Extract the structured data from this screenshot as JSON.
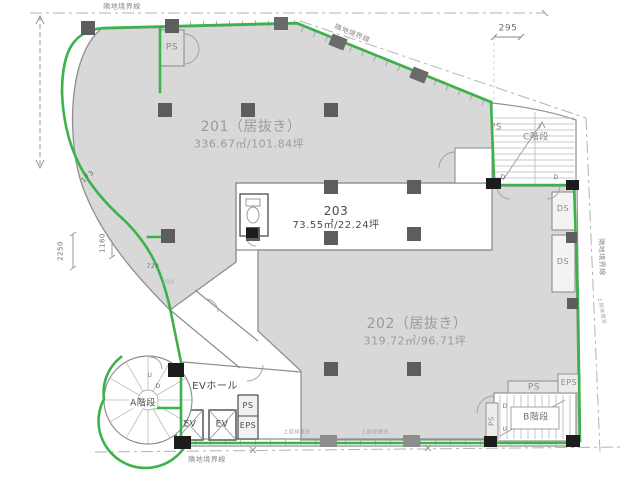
{
  "rooms": {
    "r201": {
      "name": "201（居抜き）",
      "area": "336.67㎡/101.84坪"
    },
    "r203": {
      "name": "203",
      "area": "73.55㎡/22.24坪"
    },
    "r202": {
      "name": "202（居抜き）",
      "area": "319.72㎡/96.71坪"
    }
  },
  "stairs": {
    "a": "A階段",
    "b": "B階段",
    "c": "C階段"
  },
  "elevator": {
    "hall": "EVホール",
    "cab": "EV"
  },
  "shafts": {
    "ps": "PS",
    "eps": "EPS",
    "ds": "DS"
  },
  "boundary": {
    "label": "隣地境界線"
  },
  "dims": {
    "d295": "295",
    "d173": "173",
    "d2250": "2250",
    "d1160": "1160",
    "d728": "728",
    "d700": "700"
  },
  "markers": {
    "up": "U",
    "down": "D"
  },
  "notes": {
    "vent": "上部排煙窓"
  },
  "colors": {
    "lease_green": "#3bb34a",
    "room_gray": "#d8d8d8",
    "wall_gray": "#8f8f8f",
    "column_dark": "#5d5d5d",
    "block_black": "#1c1c1c",
    "boundary_gray": "#b3b3b3",
    "text_gray": "#8a8a8a",
    "text_dark": "#4a4a4a"
  }
}
